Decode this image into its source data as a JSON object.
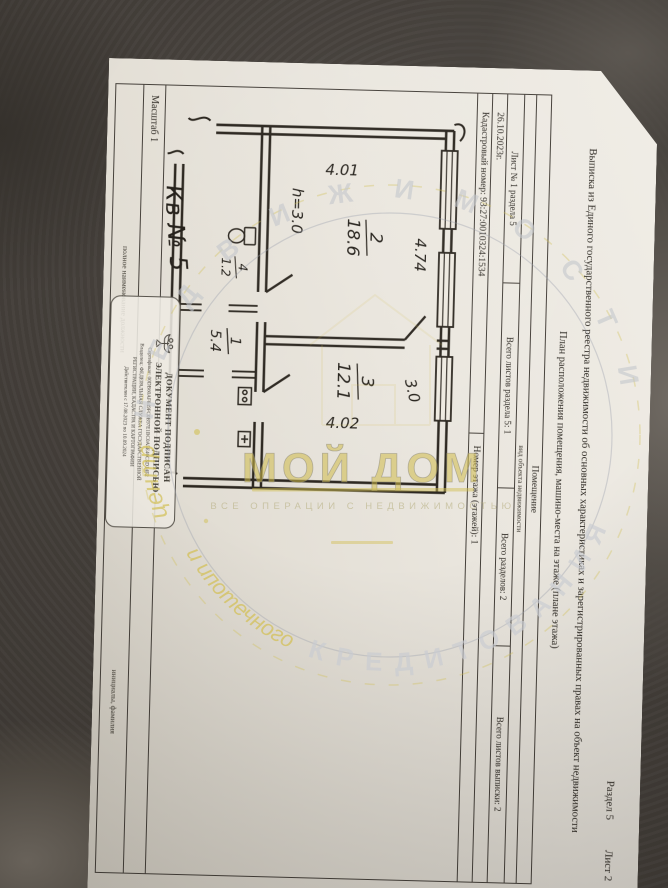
{
  "document": {
    "corner": {
      "section": "Раздел 5",
      "sheet": "Лист 2"
    },
    "title": "Выписка из Единого государственного реестра недвижимости об основных характеристиках и зарегистрированных правах на объект недвижимости",
    "subtitle": "План расположения помещения, машино-места на этаже (плане этажа)",
    "object": {
      "value": "Помещение",
      "caption": "вид объекта недвижимости"
    },
    "sheets_row": [
      "Лист № 1 раздела 5",
      "Всего листов раздела 5: 1",
      "Всего разделов: 2",
      "Всего листов выписки: 2"
    ],
    "date": "26.10.2023г.",
    "cadastral": {
      "number": "Кадастровый номер: 93:27:0010324:1534",
      "floor": "Номер этажа (этажей): 1"
    },
    "scale": "Масштаб 1",
    "signature": {
      "position_label": "полное наименование должности",
      "name_label": "инициалы, фамилия"
    },
    "stamp": {
      "title1": "ДОКУМЕНТ ПОДПИСАН",
      "title2": "ЭЛЕКТРОННОЙ ПОДПИСЬЮ",
      "certificate": "Сертификат: 00DB60AF849FC0B97E1BC0A5E46C5D14F2",
      "owner1": "Владелец: ФЕДЕРАЛЬНАЯ СЛУЖБА ГОСУДАРСТВЕННОЙ",
      "owner2": "РЕГИСТРАЦИИ, КАДАСТРА И КАРТОГРАФИИ",
      "validity": "Действителен с 17.08.2023 по 10.09.2024"
    },
    "plan": {
      "apartment_label": "Кв № 5",
      "height_note": "h=3.0",
      "dim_room2_depth": "4.01",
      "dim_room2_width": "4.74",
      "dim_room3_width": "3.0",
      "dim_room3_depth": "4.02",
      "rooms": [
        {
          "number": "2",
          "area": "18.6"
        },
        {
          "number": "3",
          "area": "12.1"
        },
        {
          "number": "1",
          "area": "5.4"
        },
        {
          "number": "4",
          "area": "1.2"
        }
      ]
    }
  },
  "watermark": {
    "arc_top_script": "центр",
    "arc_top_caps": "НЕДВИЖИМОСТИ",
    "brand": "МОЙ ДОМ",
    "tagline": "ВСЕ ОПЕРАЦИИ С НЕДВИЖИМОСТЬЮ",
    "arc_bottom_script": "и ипотечного",
    "arc_bottom_caps": "кредитования",
    "accent_color": "#d2bf54"
  }
}
